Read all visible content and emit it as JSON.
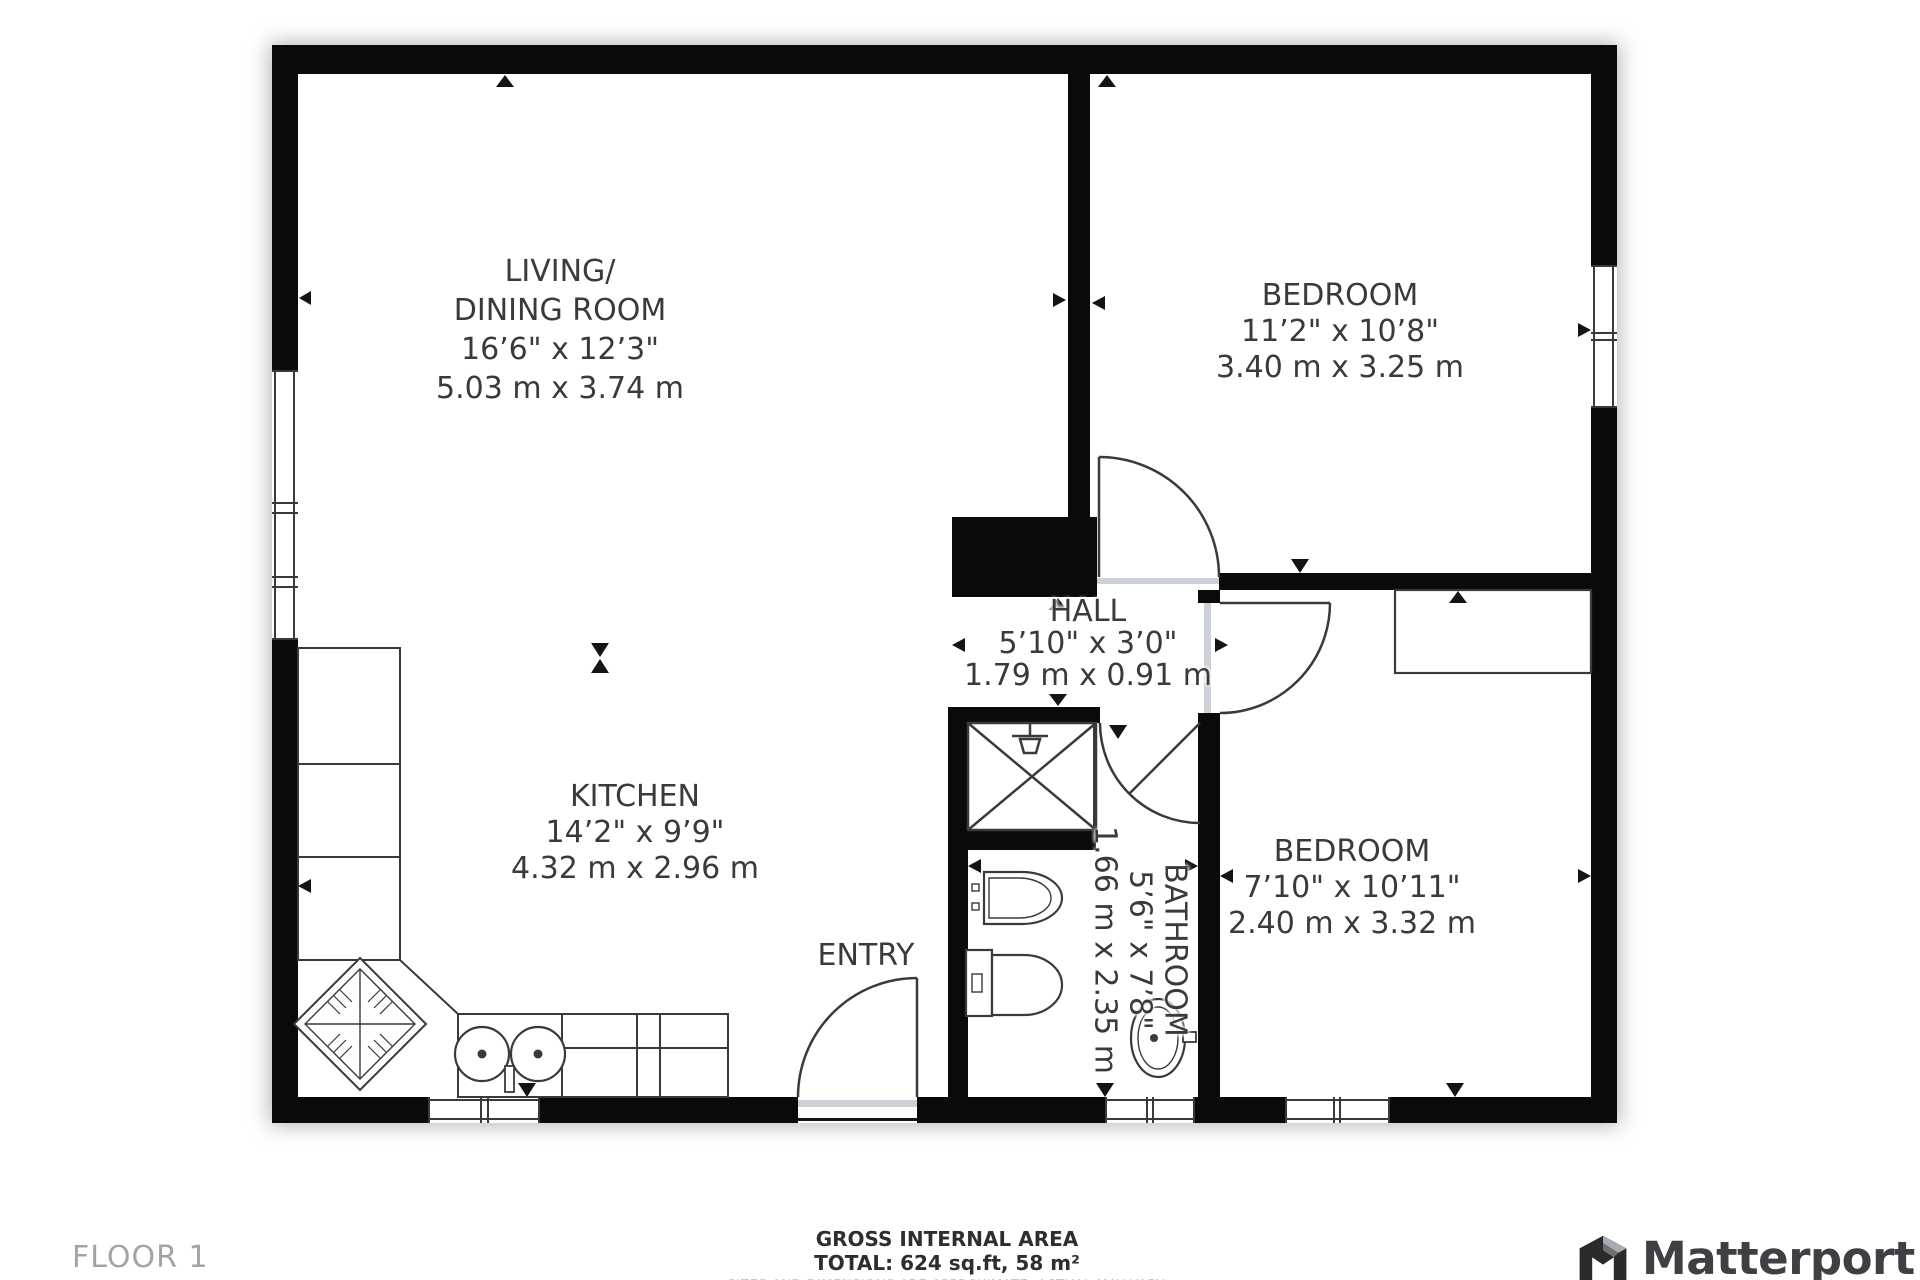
{
  "colors": {
    "wall": "#0a0a0a",
    "line": "#3a3a3a",
    "label": "#3a3a3a",
    "muted_label": "#a4a4a4",
    "threshold": "#ccd1d7"
  },
  "rooms": {
    "living": {
      "lines": [
        "LIVING/",
        "DINING ROOM",
        "16’6\" x 12’3\"",
        "5.03 m x 3.74 m"
      ]
    },
    "bedroom1": {
      "lines": [
        "BEDROOM",
        "11’2\" x 10’8\"",
        "3.40 m x 3.25 m"
      ]
    },
    "hall": {
      "lines": [
        "HALL",
        "5’10\" x 3’0\"",
        "1.79 m x 0.91 m"
      ]
    },
    "kitchen": {
      "lines": [
        "KITCHEN",
        "14’2\" x 9’9\"",
        "4.32 m x 2.96 m"
      ]
    },
    "bathroom": {
      "lines": [
        "BATHROOM",
        "5’6\" x 7’8\"",
        "1.66 m x 2.35 m"
      ]
    },
    "bedroom2": {
      "lines": [
        "BEDROOM",
        "7’10\" x 10’11\"",
        "2.40 m x 3.32 m"
      ]
    },
    "entry": {
      "label": "ENTRY"
    }
  },
  "footer": {
    "floor_label": "FLOOR 1",
    "area_title": "GROSS INTERNAL AREA",
    "area_total": "TOTAL: 624 sq.ft, 58 m²",
    "disclaimer": "SIZES AND DIMENSIONS ARE APPROXIMATE, ACTUAL MAY VARY."
  },
  "brand": {
    "name": "Matterport"
  }
}
